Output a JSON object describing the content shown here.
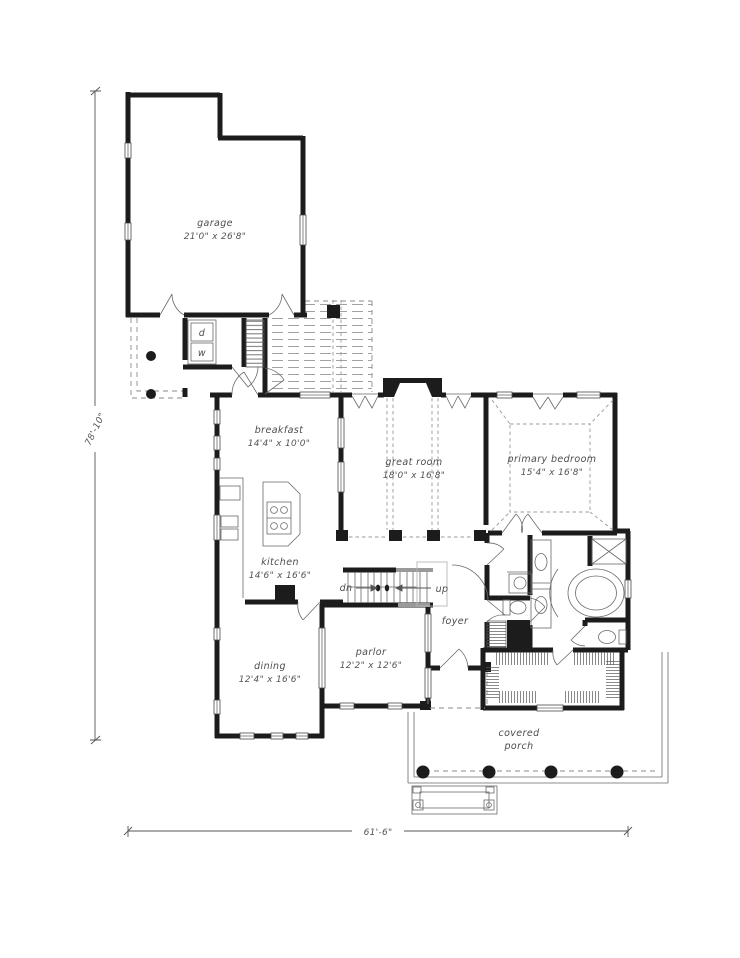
{
  "plan": {
    "rooms": {
      "garage": {
        "name": "garage",
        "dims": "21'0\" x 26'8\""
      },
      "breakfast": {
        "name": "breakfast",
        "dims": "14'4\" x 10'0\""
      },
      "great_room": {
        "name": "great room",
        "dims": "18'0\" x 16'8\""
      },
      "primary_bedroom": {
        "name": "primary bedroom",
        "dims": "15'4\" x 16'8\""
      },
      "kitchen": {
        "name": "kitchen",
        "dims": "14'6\" x 16'6\""
      },
      "dining": {
        "name": "dining",
        "dims": "12'4\" x 16'6\""
      },
      "parlor": {
        "name": "parlor",
        "dims": "12'2\" x 12'6\""
      },
      "foyer": {
        "name": "foyer"
      },
      "covered_porch": {
        "line1": "covered",
        "line2": "porch"
      }
    },
    "stairs": {
      "down": "dn",
      "up": "up"
    },
    "appliances": {
      "dryer": "d",
      "washer": "w"
    },
    "overall_dimensions": {
      "depth": "78'-10\"",
      "width": "61'-6\""
    },
    "colors": {
      "wall": "#1c1c1c",
      "line": "#4a4a4a",
      "label": "#4d4d4d",
      "hatch": "#8a8a8a",
      "background": "#ffffff"
    }
  }
}
